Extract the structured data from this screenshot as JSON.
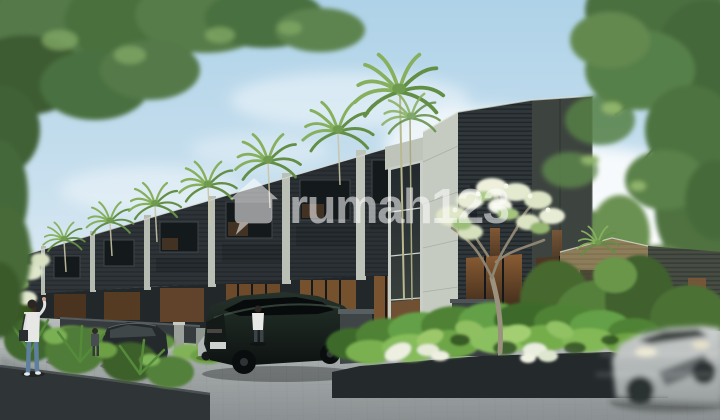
{
  "scene": {
    "type": "architectural-render-photo",
    "description": "3D render of a modern tropical townhouse row: dark slatted two-storey units with light concrete party walls receding to the left, palm trees between units, a frangipani tree at the corner unit, lush planted beds, a paver driveway with parked SUVs, pedestrians, and a motion-blurred silver car passing in the right foreground under a partly cloudy sky.",
    "watermark": {
      "text": "rumah123",
      "icon": "rumah123-house-logo-icon",
      "color": "#ffffff",
      "opacity": 0.55
    },
    "palette": {
      "sky_top": "#aed2e8",
      "sky_horizon": "#eef4f6",
      "cloud": "#ffffff",
      "foliage_dark": "#3f5c31",
      "foliage_mid": "#5d8443",
      "foliage_light": "#8ab364",
      "facade_dark": "#2d3236",
      "facade_panel": "#3d443f",
      "concrete_light": "#c6cbc1",
      "window_glass": "#14191c",
      "window_warm": "#7a5331",
      "road_paver": "#a9aeae",
      "flower_white": "#ecefdb",
      "car_dark": "#1e2427",
      "car_silver": "#b7bcbc"
    }
  }
}
